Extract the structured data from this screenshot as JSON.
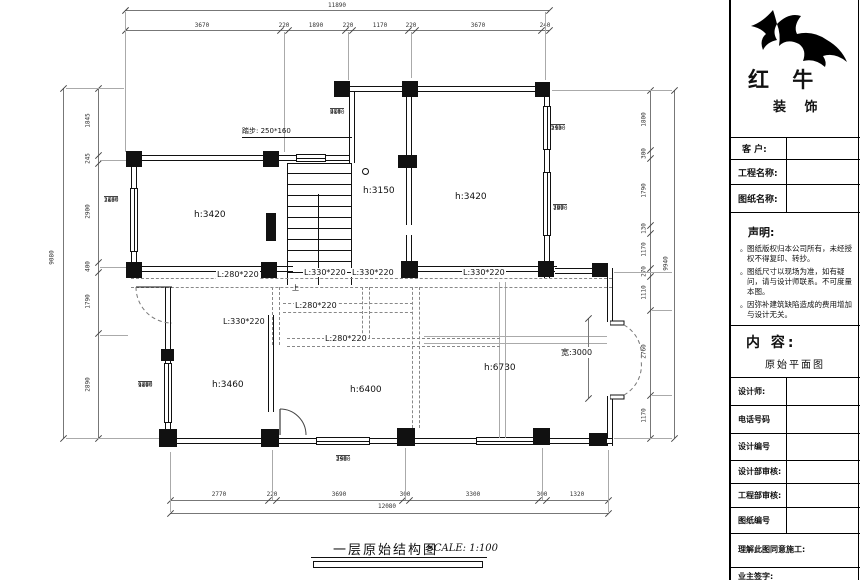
{
  "logo": {
    "brand": "红 牛",
    "sub": "装 饰"
  },
  "titleblock": {
    "fields": [
      {
        "label": "客  户:"
      },
      {
        "label": "工程名称:"
      },
      {
        "label": "图纸名称:"
      }
    ],
    "statement": {
      "title": "声明:",
      "items": [
        "图纸版权归本公司所有，未经授权不得复印、转抄。",
        "图纸尺寸以现场为准，如有疑问，请与设计师联系。不可度量本图。",
        "因弥补建筑缺陷造成的费用增加与设计无关。"
      ]
    },
    "content": {
      "label": "内 容:",
      "value": "原始平面图"
    },
    "rows": [
      {
        "label": "设计师:"
      },
      {
        "label": "电话号码"
      },
      {
        "label": "设计编号"
      },
      {
        "label": "设计部审核:"
      },
      {
        "label": "工程部审核:"
      },
      {
        "label": "图纸编号"
      }
    ],
    "footer": [
      {
        "label": "理解此图同意施工:"
      },
      {
        "label": "业主签字:"
      }
    ]
  },
  "plan": {
    "rooms": [
      {
        "label": "h:3420"
      },
      {
        "label": "h:3150"
      },
      {
        "label": "h:3420"
      },
      {
        "label": "h:3460"
      },
      {
        "label": "h:6400"
      },
      {
        "label": "h:6730"
      }
    ],
    "beams": [
      {
        "label": "L:280*220"
      },
      {
        "label": "L:330*220"
      },
      {
        "label": "L:330*220"
      },
      {
        "label": "L:330*220"
      },
      {
        "label": "L:280*220"
      },
      {
        "label": "L:330*220"
      },
      {
        "label": "L:280*220"
      }
    ],
    "stair": {
      "label": "踏步: 250*160",
      "up": "上"
    },
    "door_width": "宽:3000",
    "stacks": [
      {
        "values": [
          "320",
          "3140",
          "950"
        ]
      },
      {
        "values": [
          "545",
          "2930",
          "110"
        ]
      },
      {
        "values": [
          "300",
          "1970",
          "780"
        ]
      },
      {
        "values": [
          "1230",
          "2650",
          "110"
        ]
      },
      {
        "values": [
          "1280",
          "1190",
          "900"
        ]
      },
      {
        "values": [
          "340",
          "2980",
          "150"
        ]
      }
    ],
    "dims": {
      "top": {
        "total": "11890",
        "segments": [
          "3670",
          "220",
          "1890",
          "220",
          "1170",
          "220",
          "3670",
          "240"
        ]
      },
      "bottom": {
        "total": "12080",
        "segments": [
          "2770",
          "220",
          "3690",
          "300",
          "3300",
          "300",
          "1320"
        ]
      },
      "left": {
        "total": "9080",
        "segments": [
          "1845",
          "245",
          "2900",
          "400",
          "1790",
          "2890"
        ]
      },
      "right": {
        "total": "9940",
        "segments": [
          "1800",
          "300",
          "1790",
          "130",
          "1170",
          "270",
          "1110",
          "2760",
          "1170"
        ]
      }
    }
  },
  "footer_title": {
    "title": "一层原始结构图",
    "scale": "SCALE: 1:100"
  }
}
